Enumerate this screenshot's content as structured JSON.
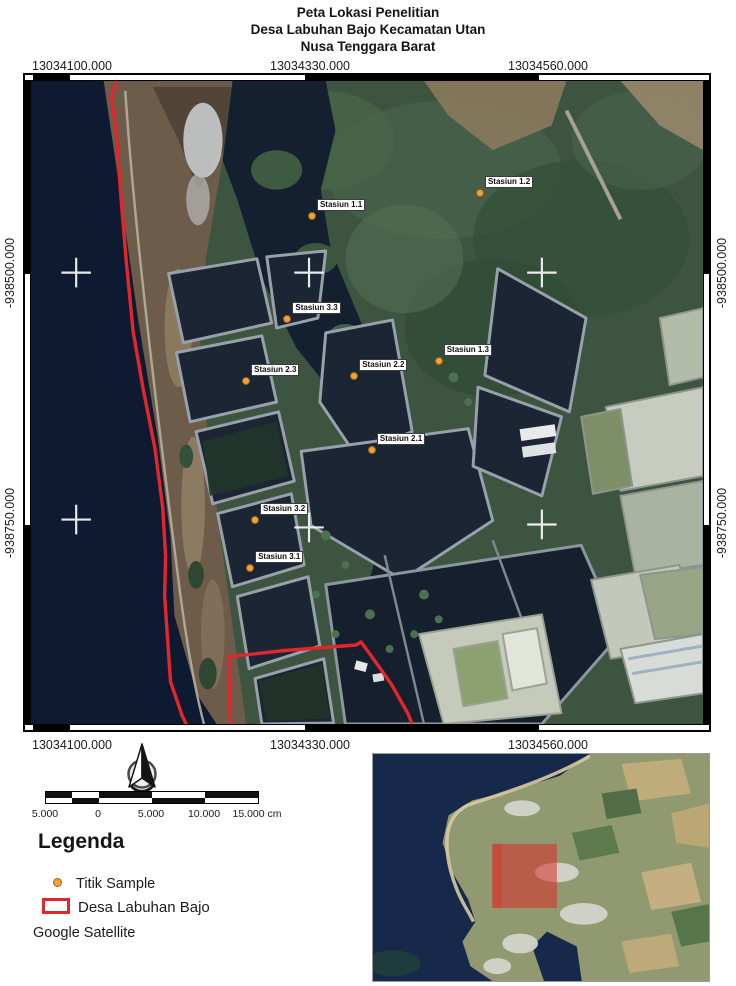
{
  "title": {
    "line1": "Peta Lokasi Penelitian",
    "line2": "Desa Labuhan Bajo Kecamatan Utan",
    "line3": "Nusa Tenggara Barat"
  },
  "map": {
    "grid": {
      "x_labels": [
        "13034100.000",
        "13034330.000",
        "13034560.000"
      ],
      "y_labels": [
        "-938500.000",
        "-938750.000"
      ]
    },
    "stations": [
      {
        "name": "Stasiun 1.1",
        "x": 286,
        "y": 137
      },
      {
        "name": "Stasiun 1.2",
        "x": 457,
        "y": 113
      },
      {
        "name": "Stasiun 1.3",
        "x": 415,
        "y": 283
      },
      {
        "name": "Stasiun 2.1",
        "x": 347,
        "y": 374
      },
      {
        "name": "Stasiun 2.2",
        "x": 329,
        "y": 299
      },
      {
        "name": "Stasiun 2.3",
        "x": 219,
        "y": 304
      },
      {
        "name": "Stasiun 3.1",
        "x": 223,
        "y": 493
      },
      {
        "name": "Stasiun 3.2",
        "x": 228,
        "y": 444
      },
      {
        "name": "Stasiun 3.3",
        "x": 261,
        "y": 241
      }
    ]
  },
  "scale_bar": {
    "labels": [
      "5.000",
      "0",
      "5.000",
      "10.000",
      "15.000"
    ],
    "unit": "cm"
  },
  "legend": {
    "heading": "Legenda",
    "items": [
      {
        "label": "Titik Sample",
        "symbol": "orange-dot"
      },
      {
        "label": "Desa Labuhan Bajo",
        "symbol": "red-rectangle"
      },
      {
        "label": "Google Satellite",
        "symbol": "none"
      }
    ]
  },
  "colors": {
    "boundary_red": "#e2262b",
    "sample_point_orange": "#f0a33a",
    "ocean_dark": "#0e1a31",
    "forest_green": "#3c5440",
    "pond_dark": "#1c2534",
    "highlight_red": "#d92d28"
  }
}
